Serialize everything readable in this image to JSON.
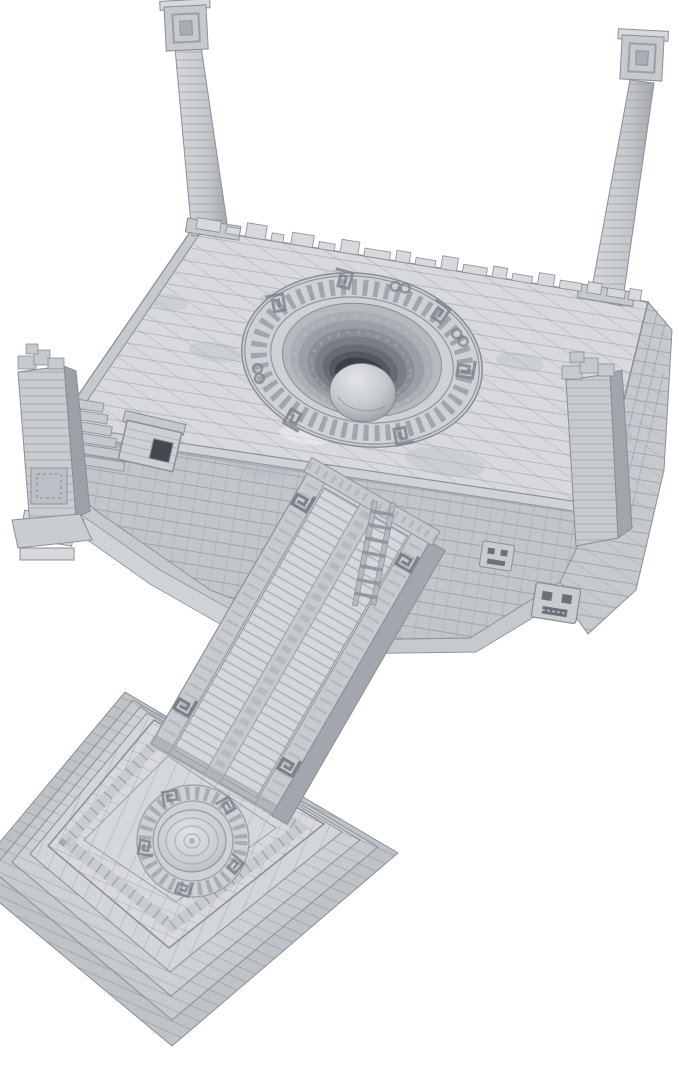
{
  "meta": {
    "background": "#ffffff",
    "alt": "Unpainted gray 3D-printed Aztec temple terrain miniature: a large square sacrificial platform with a central stepped circular pit holding a stone sphere, two tall brick pillars at the rear corners, ruined pillar stubs at the front corners, carved mask glyphs on the walls, and a long carved processional ramp descending to a small stepped altar platform with a polished oval disc."
  },
  "palette": {
    "bg": "#ffffff",
    "outline": "#8b8e94",
    "crevice": "#8f939a",
    "stoneLight": "#e7e9eb",
    "stoneTop": "#d7d9dc",
    "stoneMid": "#c6c9cd",
    "stoneWall": "#c2c5ca",
    "stoneDark": "#a5a8ae",
    "pitDeep": "#3c3f45"
  },
  "scene": {
    "alt": "Aztec-style temple platform miniature with central pit, sphere, pillars, ramp and stepped altar on a white background",
    "parts": [
      {
        "id": "back-left-pillar",
        "label": "Tall masonry pillar (back left corner)"
      },
      {
        "id": "back-right-pillar",
        "label": "Tall masonry pillar (back right corner)"
      },
      {
        "id": "main-platform",
        "label": "Main temple platform with brick paving"
      },
      {
        "id": "central-pit",
        "label": "Central stepped circular pit with glyph ring"
      },
      {
        "id": "pit-sphere",
        "label": "Stone sphere resting in the pit"
      },
      {
        "id": "ruined-pillar-left",
        "label": "Ruined corner pillar with fallen block (front left)"
      },
      {
        "id": "ruined-pillar-right",
        "label": "Ruined corner pillar stub (right corner)"
      },
      {
        "id": "wall-masks",
        "label": "Carved mask glyphs on the wall"
      },
      {
        "id": "ramp",
        "label": "Carved processional ramp with spiral motifs"
      },
      {
        "id": "ladder",
        "label": "Ladder beside the ramp"
      },
      {
        "id": "altar-platform",
        "label": "Stepped altar platform"
      },
      {
        "id": "altar-disc",
        "label": "Polished oval altar disc with spiral ring"
      }
    ]
  }
}
